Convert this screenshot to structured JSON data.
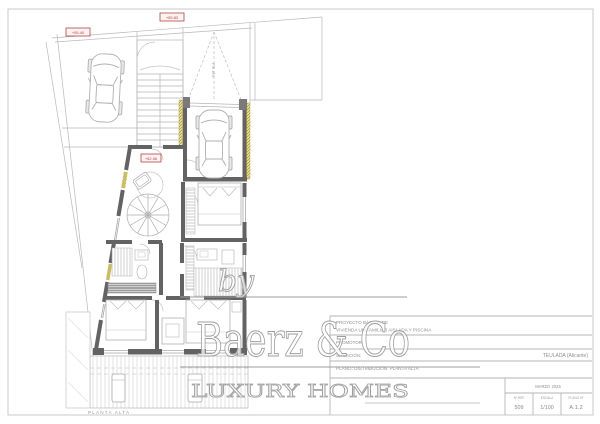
{
  "sheet": {
    "plan_caption": "PLANTA ALTA",
    "levels": {
      "street_upper": "+55.40",
      "street_lower": "+55.83",
      "floor": "+52.56"
    },
    "ramp_note": "PTE. 16%"
  },
  "watermark": {
    "by": "by",
    "brand": "Baerz & Co",
    "tagline": "LUXURY HOMES"
  },
  "title_block": {
    "project_line1": "PROYECTO BÁSICO DE",
    "project_line2": "VIVIENDA UNIFAMILIAR AISLADA Y PISCINA",
    "promoter_label": "PROMOTOR:",
    "location_label": "SITUACIÓN:",
    "location_value": "TEULADA (Alicante)",
    "plan_line": "PLANO: DISTRIBUCIÓN. PLANTA ALTA",
    "date": "MARZO 2025",
    "ref_label": "Nº REF",
    "ref_value": "509",
    "scale_label": "ESCALA",
    "scale_value": "1/100",
    "sheet_label": "PLANO Nº",
    "sheet_value": "A.1.2"
  },
  "colors": {
    "wall": "#636363",
    "line_light": "#b5b5b5",
    "insulation_yellow": "#e3d univ",
    "level_red": "#b54444",
    "watermark_gray": "#a6a6a6",
    "titleblock_text": "#8f8f8f"
  }
}
